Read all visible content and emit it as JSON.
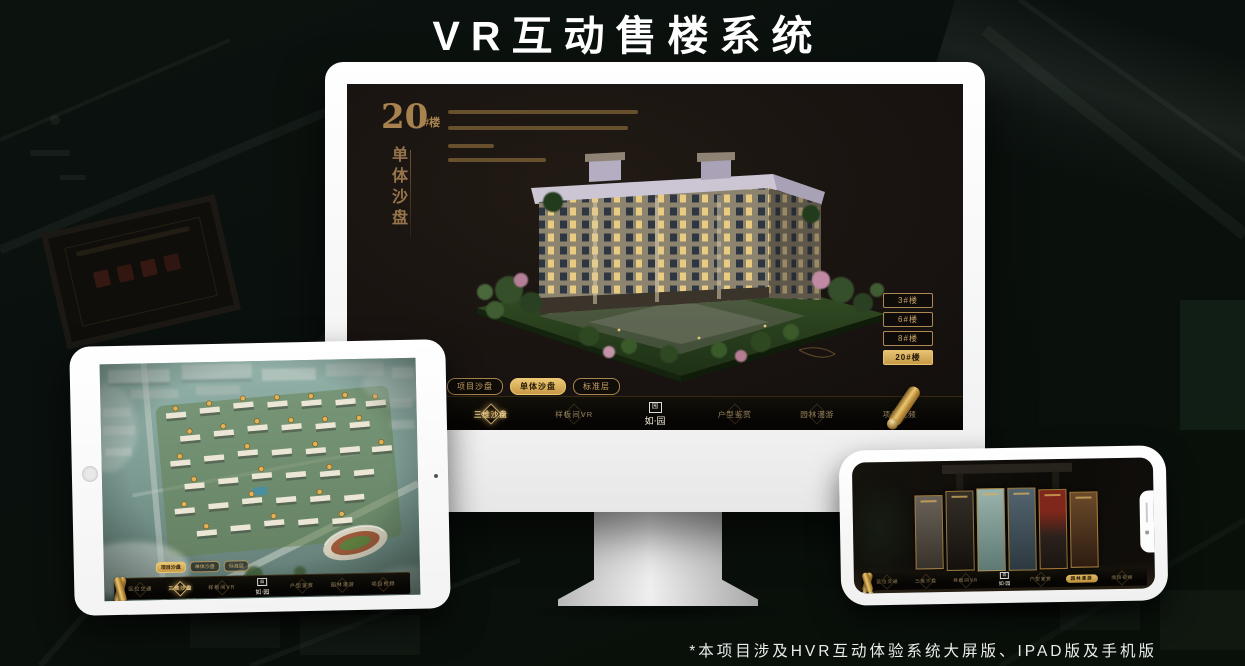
{
  "page": {
    "title": "VR互动售楼系统",
    "footnote": "*本项目涉及HVR互动体验系统大屏版、IPAD版及手机版"
  },
  "brand": {
    "seal": "园",
    "name": "如·园"
  },
  "colors": {
    "gold": "#c9a05e",
    "gold_bright": "#ecc873",
    "tab_active": "#d4a855",
    "screen_bg": "#1a1410",
    "nav_bg": "#0b0806",
    "page_bg": "#0a0f0c"
  },
  "monitor": {
    "unit_title": {
      "number": "20",
      "suffix": "#楼",
      "name_vertical": "单体沙盘"
    },
    "floor_buttons": [
      {
        "label": "3#楼",
        "active": false
      },
      {
        "label": "6#楼",
        "active": false
      },
      {
        "label": "8#楼",
        "active": false
      },
      {
        "label": "20#楼",
        "active": true
      }
    ],
    "tabs": [
      {
        "label": "项目沙盘",
        "active": false
      },
      {
        "label": "单体沙盘",
        "active": true
      },
      {
        "label": "标准层",
        "active": false
      }
    ],
    "nav_left": [
      {
        "label": "区位交通",
        "active": false
      },
      {
        "label": "三维沙盘",
        "active": true
      },
      {
        "label": "样板间VR",
        "active": false
      }
    ],
    "nav_right": [
      {
        "label": "户型鉴赏",
        "active": false
      },
      {
        "label": "园林漫游",
        "active": false
      },
      {
        "label": "项目视频",
        "active": false
      }
    ]
  },
  "tablet": {
    "tabs": [
      {
        "label": "项目沙盘",
        "active": true
      },
      {
        "label": "单体沙盘",
        "active": false
      },
      {
        "label": "标准层",
        "active": false
      }
    ],
    "nav_left": [
      {
        "label": "区位交通",
        "active": false
      },
      {
        "label": "三维沙盘",
        "active": true
      },
      {
        "label": "样板间VR",
        "active": false
      }
    ],
    "nav_right": [
      {
        "label": "户型鉴赏",
        "active": false
      },
      {
        "label": "园林漫游",
        "active": false
      },
      {
        "label": "项目视频",
        "active": false
      }
    ]
  },
  "phone": {
    "nav_left": [
      {
        "label": "区位交通",
        "active": false
      },
      {
        "label": "三维沙盘",
        "active": false
      },
      {
        "label": "样板间VR",
        "active": false
      }
    ],
    "nav_right": [
      {
        "label": "户型鉴赏",
        "active": false
      },
      {
        "label": "园林漫游",
        "active": true
      },
      {
        "label": "项目视频",
        "active": false
      }
    ]
  }
}
